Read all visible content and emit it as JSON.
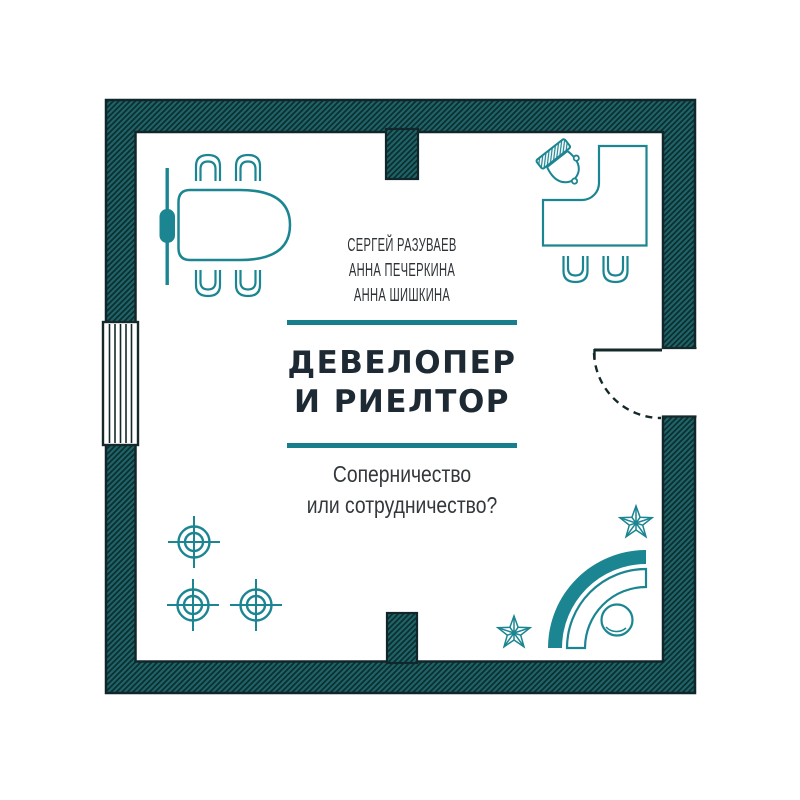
{
  "cover": {
    "authors": [
      "СЕРГЕЙ РАЗУВАЕВ",
      "АННА ПЕЧЕРКИНА",
      "АННА ШИШКИНА"
    ],
    "title_line1": "ДЕВЕЛОПЕР",
    "title_line2": "И РИЕЛТОР",
    "subtitle_line1": "Соперничество",
    "subtitle_line2": "или сотрудничество?"
  },
  "colors": {
    "accent_teal": "#177f8c",
    "furniture_teal": "#1b8591",
    "wall_fill": "#1d6468",
    "wall_stripe": "#0e2d2f",
    "wall_border": "#10262a",
    "title_dark": "#1e2a33",
    "text_gray": "#33383c",
    "background": "#ffffff"
  },
  "floorplan_icons": [
    "exterior-wall",
    "partition-wall",
    "window",
    "door-swing",
    "presentation-board",
    "conference-table",
    "chair",
    "office-desk",
    "office-chair",
    "guest-chair",
    "reception-desk",
    "stool",
    "ceiling-light",
    "plant"
  ]
}
